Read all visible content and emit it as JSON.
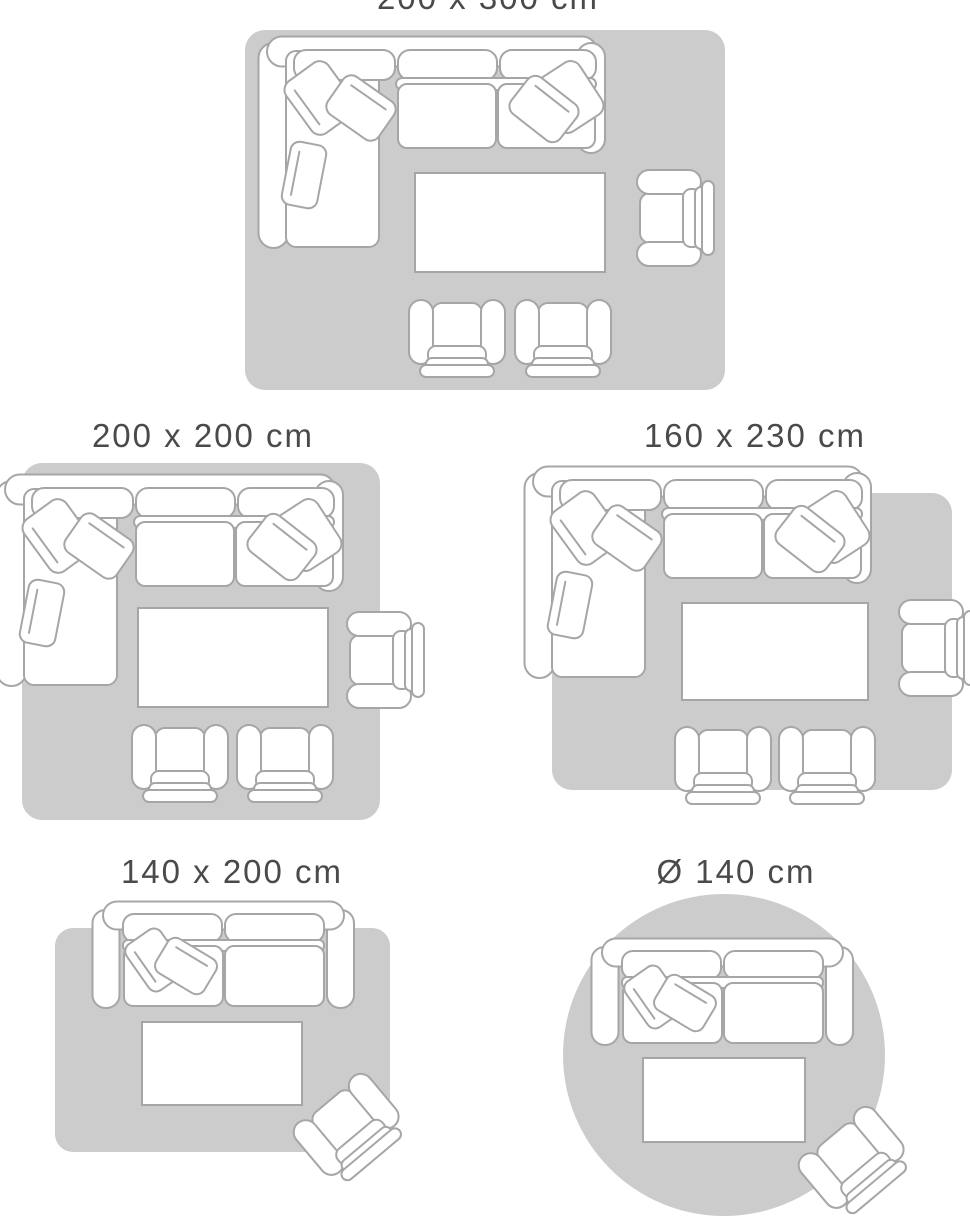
{
  "page_title": "Rug size guide",
  "colors": {
    "background": "#ffffff",
    "rug_fill": "#cccccc",
    "furniture_outline": "#a6a6a6",
    "furniture_fill": "#ffffff",
    "label_text": "#4a4a4a"
  },
  "size_guide": {
    "layouts": [
      {
        "label": "200 x 300 cm",
        "rug_shape": "rectangle",
        "furniture": [
          "corner-sofa",
          "coffee-table",
          "armchair",
          "club-chair",
          "club-chair"
        ]
      },
      {
        "label": "200 x 200 cm",
        "rug_shape": "square",
        "furniture": [
          "corner-sofa",
          "coffee-table",
          "armchair",
          "club-chair",
          "club-chair"
        ]
      },
      {
        "label": "160 x 230 cm",
        "rug_shape": "rectangle",
        "furniture": [
          "corner-sofa",
          "coffee-table",
          "armchair",
          "club-chair",
          "club-chair"
        ]
      },
      {
        "label": "140 x 200 cm",
        "rug_shape": "rectangle",
        "furniture": [
          "two-seater-sofa",
          "coffee-table",
          "armchair"
        ]
      },
      {
        "label": "Ø 140 cm",
        "rug_shape": "circle",
        "furniture": [
          "two-seater-sofa",
          "coffee-table",
          "armchair"
        ]
      }
    ]
  }
}
